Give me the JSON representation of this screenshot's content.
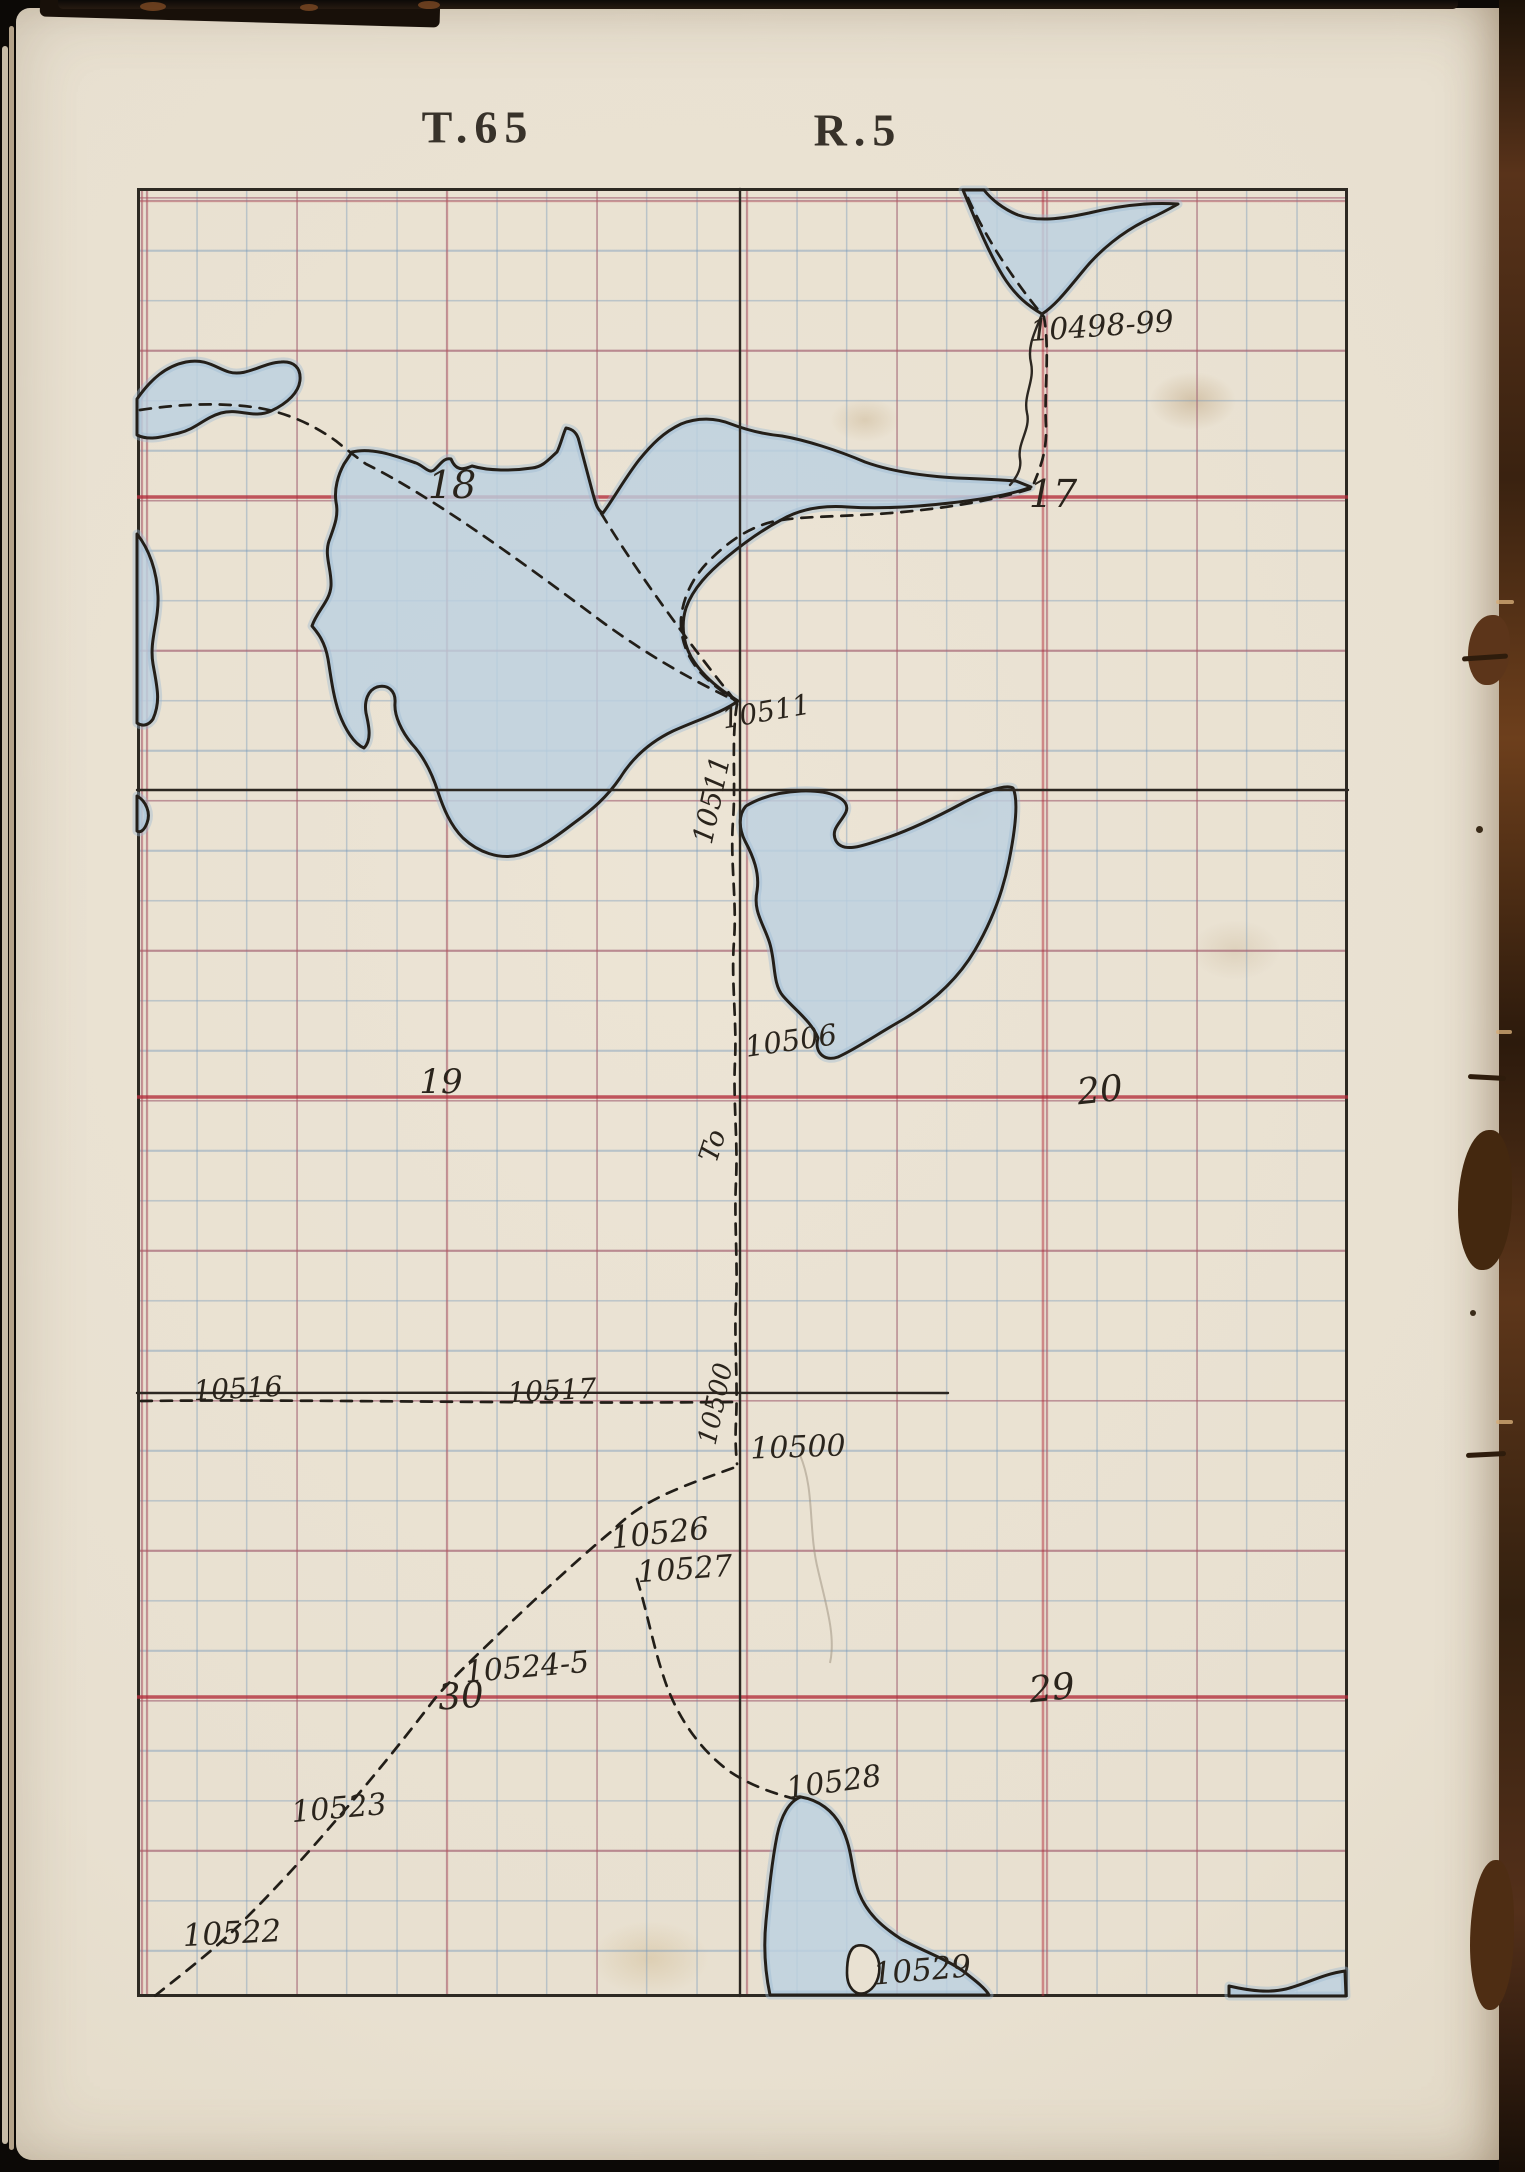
{
  "header": {
    "township": "T.65",
    "range": "R.5"
  },
  "map": {
    "sections": {
      "s18": "18",
      "s17": "17",
      "s19": "19",
      "s20": "20",
      "s30": "30",
      "s29": "29"
    },
    "stations": {
      "s10498_99": "10498-99",
      "s10511": "10511",
      "s10511_vertical": "10511",
      "s10506": "10506",
      "s10500_vertical": "10500",
      "s10500": "10500",
      "s10516": "10516",
      "s10517": "10517",
      "s10526": "10526",
      "s10527": "10527",
      "s10524_5": "10524-5",
      "s10523": "10523",
      "s10522": "10522",
      "s10528": "10528",
      "s10529": "10529",
      "to_mark": "To"
    }
  },
  "colors": {
    "paper": "#e9e1d2",
    "grid_blue": "#7094b8",
    "grid_red": "#be5258",
    "section_red": "#b22c3a",
    "ink": "#2a241c",
    "water_fill": "#bcd1e1",
    "water_outline": "#241f19",
    "binding_leather": "#5c351a"
  }
}
